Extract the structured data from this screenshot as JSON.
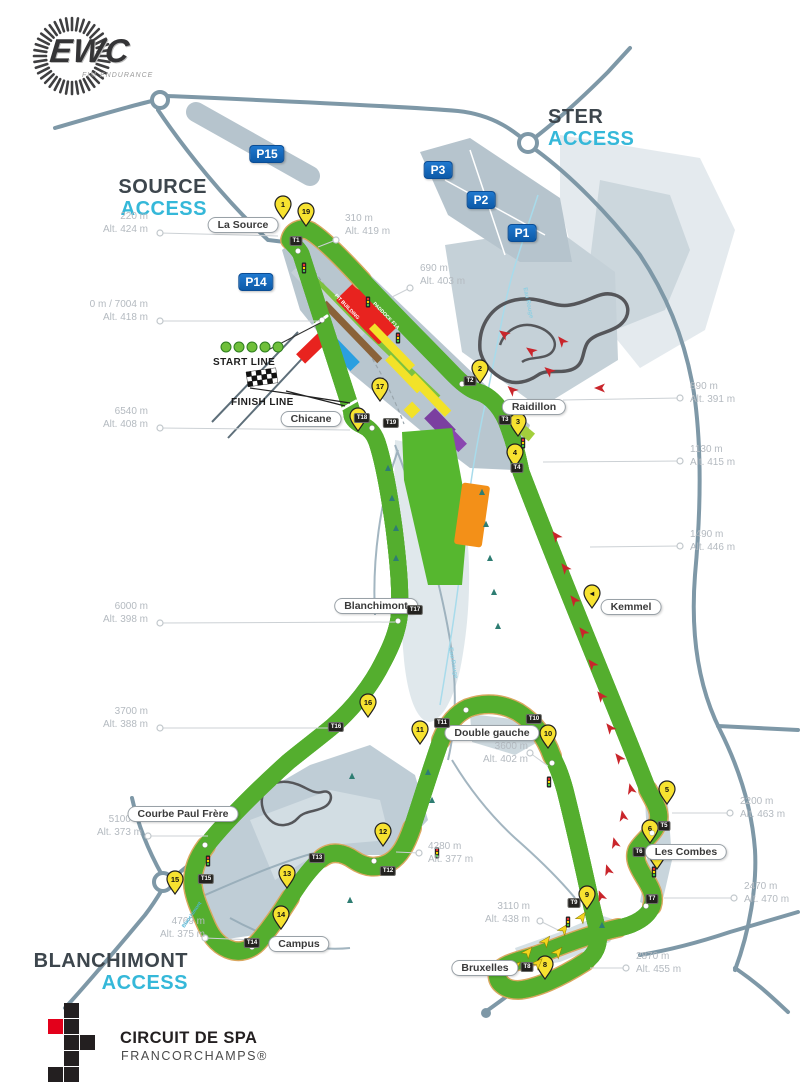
{
  "logos": {
    "ewc": {
      "text": "EWC",
      "subtext": "FIM ENDURANCE"
    },
    "spa": {
      "line1": "CIRCUIT DE SPA",
      "line2": "FRANCORCHAMPS®"
    }
  },
  "colors": {
    "accent_cyan": "#35b8d9",
    "parking_blue": "#1668b5",
    "pin_yellow": "#f7e230",
    "track_gray": "#4a4a4c",
    "gravel_tan": "#d9a75f",
    "runoff_green": "#54ae2e",
    "arrow_red": "#c9252b",
    "logo_red": "#e3001b"
  },
  "access_labels": [
    {
      "id": "ster",
      "line1": "STER",
      "line2": "ACCESS",
      "x": 548,
      "y": 106,
      "align": "left",
      "w": 140
    },
    {
      "id": "source",
      "line1": "SOURCE",
      "line2": "ACCESS",
      "x": 87,
      "y": 176,
      "align": "right",
      "w": 120
    },
    {
      "id": "blanchimont",
      "line1": "BLANCHIMONT",
      "line2": "ACCESS",
      "x": 28,
      "y": 950,
      "align": "right",
      "w": 160
    }
  ],
  "lines": {
    "start_label": "START LINE",
    "finish_label": "FINISH LINE"
  },
  "parkings": [
    {
      "label": "P15",
      "x": 267,
      "y": 154
    },
    {
      "label": "P3",
      "x": 438,
      "y": 170
    },
    {
      "label": "P2",
      "x": 481,
      "y": 200
    },
    {
      "label": "P1",
      "x": 522,
      "y": 233
    },
    {
      "label": "P14",
      "x": 256,
      "y": 282
    }
  ],
  "corners": [
    {
      "label": "La Source",
      "x": 243,
      "y": 225
    },
    {
      "label": "Raidillon",
      "x": 534,
      "y": 407
    },
    {
      "label": "Chicane",
      "x": 311,
      "y": 419
    },
    {
      "label": "Blanchimont",
      "x": 376,
      "y": 606
    },
    {
      "label": "Kemmel",
      "x": 631,
      "y": 607
    },
    {
      "label": "Double gauche",
      "x": 492,
      "y": 733
    },
    {
      "label": "Les Combes",
      "x": 686,
      "y": 852
    },
    {
      "label": "Courbe Paul Frère",
      "x": 183,
      "y": 814
    },
    {
      "label": "Campus",
      "x": 299,
      "y": 944
    },
    {
      "label": "Bruxelles",
      "x": 485,
      "y": 968
    }
  ],
  "markers": [
    {
      "d": "220 m",
      "alt": "Alt. 424 m",
      "tx": 38,
      "ty": 210,
      "align": "right",
      "cx": 160,
      "cy": 233,
      "ax": 278,
      "ay": 236
    },
    {
      "d": "0 m / 7004 m",
      "alt": "Alt. 418 m",
      "tx": 38,
      "ty": 298,
      "align": "right",
      "cx": 160,
      "cy": 321,
      "ax": 320,
      "ay": 321
    },
    {
      "d": "6540 m",
      "alt": "Alt. 408 m",
      "tx": 38,
      "ty": 405,
      "align": "right",
      "cx": 160,
      "cy": 428,
      "ax": 350,
      "ay": 430
    },
    {
      "d": "6000 m",
      "alt": "Alt. 398 m",
      "tx": 38,
      "ty": 600,
      "align": "right",
      "cx": 160,
      "cy": 623,
      "ax": 396,
      "ay": 622
    },
    {
      "d": "3700 m",
      "alt": "Alt. 388 m",
      "tx": 38,
      "ty": 705,
      "align": "right",
      "cx": 160,
      "cy": 728,
      "ax": 330,
      "ay": 728
    },
    {
      "d": "5100 m",
      "alt": "Alt. 373 m",
      "tx": 32,
      "ty": 813,
      "align": "right",
      "cx": 148,
      "cy": 836,
      "ax": 208,
      "ay": 836
    },
    {
      "d": "4769 m",
      "alt": "Alt. 375 m",
      "tx": 95,
      "ty": 915,
      "align": "right",
      "cx": 205,
      "cy": 938,
      "ax": 255,
      "ay": 940
    },
    {
      "d": "310 m",
      "alt": "Alt. 419 m",
      "tx": 345,
      "ty": 212,
      "align": "left",
      "cx": 336,
      "cy": 240,
      "ax": 318,
      "ay": 247
    },
    {
      "d": "690 m",
      "alt": "Alt. 403 m",
      "tx": 420,
      "ty": 262,
      "align": "left",
      "cx": 410,
      "cy": 288,
      "ax": 392,
      "ay": 297
    },
    {
      "d": "890 m",
      "alt": "Alt. 391 m",
      "tx": 690,
      "ty": 380,
      "align": "left",
      "cx": 680,
      "cy": 398,
      "ax": 563,
      "ay": 400
    },
    {
      "d": "1130 m",
      "alt": "Alt. 415 m",
      "tx": 690,
      "ty": 443,
      "align": "left",
      "cx": 680,
      "cy": 461,
      "ax": 543,
      "ay": 462
    },
    {
      "d": "1490 m",
      "alt": "Alt. 446 m",
      "tx": 690,
      "ty": 528,
      "align": "left",
      "cx": 680,
      "cy": 546,
      "ax": 590,
      "ay": 547
    },
    {
      "d": "2200 m",
      "alt": "Alt. 463 m",
      "tx": 740,
      "ty": 795,
      "align": "left",
      "cx": 730,
      "cy": 813,
      "ax": 672,
      "ay": 813
    },
    {
      "d": "2470 m",
      "alt": "Alt. 470 m",
      "tx": 744,
      "ty": 880,
      "align": "left",
      "cx": 734,
      "cy": 898,
      "ax": 664,
      "ay": 898
    },
    {
      "d": "2870 m",
      "alt": "Alt. 455 m",
      "tx": 636,
      "ty": 950,
      "align": "left",
      "cx": 626,
      "cy": 968,
      "ax": 590,
      "ay": 968
    },
    {
      "d": "3110 m",
      "alt": "Alt. 438 m",
      "tx": 420,
      "ty": 900,
      "align": "right",
      "cx": 540,
      "cy": 921,
      "ax": 562,
      "ay": 932
    },
    {
      "d": "3600 m",
      "alt": "Alt. 402 m",
      "tx": 418,
      "ty": 740,
      "align": "right",
      "cx": 530,
      "cy": 753,
      "ax": 548,
      "ay": 766
    },
    {
      "d": "4280 m",
      "alt": "Alt. 377 m",
      "tx": 428,
      "ty": 840,
      "align": "left",
      "cx": 419,
      "cy": 853,
      "ax": 396,
      "ay": 852
    }
  ],
  "turn_badges": [
    {
      "t": "T1",
      "x": 296,
      "y": 241
    },
    {
      "t": "T2",
      "x": 470,
      "y": 381
    },
    {
      "t": "T3",
      "x": 505,
      "y": 420
    },
    {
      "t": "T4",
      "x": 517,
      "y": 468
    },
    {
      "t": "T5",
      "x": 664,
      "y": 826
    },
    {
      "t": "T6",
      "x": 639,
      "y": 852
    },
    {
      "t": "T7",
      "x": 652,
      "y": 899
    },
    {
      "t": "T8",
      "x": 527,
      "y": 967
    },
    {
      "t": "T9",
      "x": 574,
      "y": 903
    },
    {
      "t": "T10",
      "x": 534,
      "y": 719
    },
    {
      "t": "T11",
      "x": 442,
      "y": 723
    },
    {
      "t": "T12",
      "x": 388,
      "y": 871
    },
    {
      "t": "T13",
      "x": 317,
      "y": 858
    },
    {
      "t": "T14",
      "x": 252,
      "y": 943
    },
    {
      "t": "T15",
      "x": 206,
      "y": 879
    },
    {
      "t": "T16",
      "x": 336,
      "y": 727
    },
    {
      "t": "T17",
      "x": 415,
      "y": 610
    },
    {
      "t": "T18",
      "x": 362,
      "y": 418
    },
    {
      "t": "T19",
      "x": 391,
      "y": 423
    }
  ],
  "pins": [
    {
      "n": "1",
      "x": 283,
      "y": 219
    },
    {
      "n": "19",
      "x": 306,
      "y": 226
    },
    {
      "n": "2",
      "x": 480,
      "y": 383
    },
    {
      "n": "3",
      "x": 518,
      "y": 436
    },
    {
      "n": "4",
      "x": 515,
      "y": 467
    },
    {
      "n": "◄",
      "x": 592,
      "y": 608
    },
    {
      "n": "5",
      "x": 667,
      "y": 804
    },
    {
      "n": "6",
      "x": 650,
      "y": 843
    },
    {
      "n": "7",
      "x": 657,
      "y": 869
    },
    {
      "n": "8",
      "x": 545,
      "y": 979
    },
    {
      "n": "9",
      "x": 587,
      "y": 909
    },
    {
      "n": "10",
      "x": 548,
      "y": 748
    },
    {
      "n": "11",
      "x": 420,
      "y": 744
    },
    {
      "n": "12",
      "x": 383,
      "y": 846
    },
    {
      "n": "13",
      "x": 287,
      "y": 888
    },
    {
      "n": "14",
      "x": 281,
      "y": 929
    },
    {
      "n": "15",
      "x": 175,
      "y": 894
    },
    {
      "n": "16",
      "x": 368,
      "y": 717
    },
    {
      "n": "17",
      "x": 380,
      "y": 401
    },
    {
      "n": "18",
      "x": 358,
      "y": 431
    }
  ],
  "red_arrows": [
    {
      "x": 556,
      "y": 536,
      "r": -38
    },
    {
      "x": 565,
      "y": 568,
      "r": -38
    },
    {
      "x": 574,
      "y": 600,
      "r": -38
    },
    {
      "x": 583,
      "y": 632,
      "r": -38
    },
    {
      "x": 592,
      "y": 664,
      "r": -38
    },
    {
      "x": 601,
      "y": 696,
      "r": -38
    },
    {
      "x": 610,
      "y": 728,
      "r": -38
    },
    {
      "x": 619,
      "y": 758,
      "r": -38
    },
    {
      "x": 631,
      "y": 789,
      "r": -15
    },
    {
      "x": 623,
      "y": 816,
      "r": -12
    },
    {
      "x": 615,
      "y": 843,
      "r": -15
    },
    {
      "x": 608,
      "y": 870,
      "r": -18
    },
    {
      "x": 601,
      "y": 896,
      "r": -22
    },
    {
      "x": 549,
      "y": 371,
      "r": -50
    },
    {
      "x": 531,
      "y": 351,
      "r": -55
    },
    {
      "x": 562,
      "y": 341,
      "r": -40
    },
    {
      "x": 512,
      "y": 390,
      "r": -48
    },
    {
      "x": 504,
      "y": 334,
      "r": -55
    },
    {
      "x": 600,
      "y": 388,
      "r": -90
    }
  ],
  "yellow_arrows": [
    {
      "x": 528,
      "y": 952,
      "r": 40
    },
    {
      "x": 546,
      "y": 941,
      "r": 38
    },
    {
      "x": 564,
      "y": 929,
      "r": 36
    },
    {
      "x": 582,
      "y": 917,
      "r": 34
    },
    {
      "x": 538,
      "y": 963,
      "r": 44
    },
    {
      "x": 516,
      "y": 966,
      "r": 48
    },
    {
      "x": 558,
      "y": 952,
      "r": 40
    }
  ],
  "signals": [
    {
      "x": 368,
      "y": 302
    },
    {
      "x": 398,
      "y": 338
    },
    {
      "x": 549,
      "y": 782
    },
    {
      "x": 568,
      "y": 922
    },
    {
      "x": 654,
      "y": 872
    },
    {
      "x": 437,
      "y": 853
    },
    {
      "x": 208,
      "y": 861
    },
    {
      "x": 523,
      "y": 443
    },
    {
      "x": 304,
      "y": 268
    }
  ],
  "trees": [
    {
      "x": 388,
      "y": 468
    },
    {
      "x": 392,
      "y": 498
    },
    {
      "x": 396,
      "y": 528
    },
    {
      "x": 396,
      "y": 558
    },
    {
      "x": 482,
      "y": 492
    },
    {
      "x": 486,
      "y": 524
    },
    {
      "x": 490,
      "y": 558
    },
    {
      "x": 494,
      "y": 592
    },
    {
      "x": 498,
      "y": 626
    },
    {
      "x": 428,
      "y": 772
    },
    {
      "x": 432,
      "y": 800
    },
    {
      "x": 352,
      "y": 776
    },
    {
      "x": 602,
      "y": 925
    },
    {
      "x": 350,
      "y": 900
    }
  ],
  "track_dots": [
    {
      "x": 322,
      "y": 320
    },
    {
      "x": 298,
      "y": 251
    },
    {
      "x": 462,
      "y": 384
    },
    {
      "x": 652,
      "y": 833
    },
    {
      "x": 497,
      "y": 971
    },
    {
      "x": 552,
      "y": 763
    },
    {
      "x": 466,
      "y": 710
    },
    {
      "x": 252,
      "y": 947
    },
    {
      "x": 205,
      "y": 845
    },
    {
      "x": 398,
      "y": 621
    },
    {
      "x": 372,
      "y": 428
    },
    {
      "x": 646,
      "y": 906
    },
    {
      "x": 374,
      "y": 861
    }
  ],
  "rotated_labels": [
    {
      "t": "Eau Rouge",
      "x": 512,
      "y": 300,
      "r": 78,
      "c": "#8fcfe2",
      "s": 6
    },
    {
      "t": "Eau Rouge",
      "x": 437,
      "y": 660,
      "r": 80,
      "c": "#8fcfe2",
      "s": 6
    },
    {
      "t": "Blanchimont",
      "x": 177,
      "y": 912,
      "r": -55,
      "c": "#4fb6d6",
      "s": 5
    },
    {
      "t": "PIT BUILDING",
      "x": 330,
      "y": 304,
      "r": 46,
      "c": "#ffffff",
      "s": 5
    },
    {
      "t": "PADDOCK F1A",
      "x": 368,
      "y": 313,
      "r": 46,
      "c": "#ffffff",
      "s": 5
    }
  ]
}
